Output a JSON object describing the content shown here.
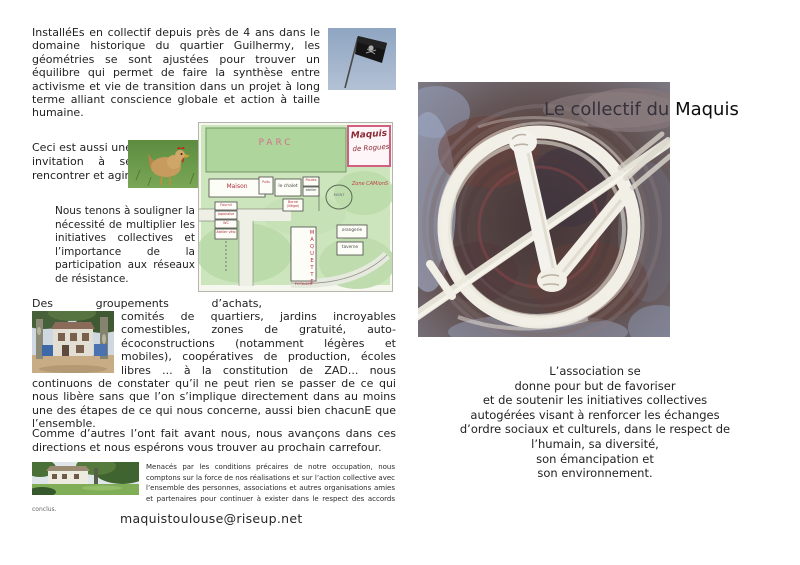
{
  "page_left": {
    "intro": "InstalléEs en collectif depuis près de 4 ans dans le domaine historique du quartier Guilhermy, les géométries se sont ajustées pour trouver un équilibre qui permet de faire la synthèse entre activisme et vie de transition dans un projet à long terme alliant conscience globale et action à taille humaine.",
    "invitation": "Ceci est aussi une invitation à se rencontrer et agir.",
    "souligner": "Nous tenons à souligner la nécessité de multiplier les initiatives collectives et l’importance de la participation aux réseaux de résistance.",
    "groupements_line1": "Des groupements d’achats,",
    "groupements_rest": "comités de quartiers, jardins incroyables comestibles, zones de gratuité, auto-écoconstructions (notamment légères et mobiles), coopératives de production, écoles libres ...  à la constitution de ZAD...  nous continuons de constater qu’il ne peut rien se passer de ce qui nous libère sans que l’on s’implique directement dans au moins une des étapes  de ce qui nous concerne, aussi bien chacunE que l’ensemble.",
    "carrefour": "Comme d’autres l’ont fait avant nous, nous avançons dans ces directions et nous espérons vous trouver au prochain carrefour.",
    "menaces": "Menacés par les conditions précaires de notre occupation, nous comptons sur la force de nos réalisations et sur l’action collective avec l’ensemble des personnes, associations et autres organisations amies et partenaires pour continuer à exister dans le respect des accords ",
    "menaces_suffix": "conclus.",
    "email": "maquistoulouse@riseup.net",
    "images": {
      "flag": "pirate-flag-photo",
      "hen": "hen-photo",
      "map": "hand-drawn-site-map",
      "house": "house-photo",
      "panorama": "house-panorama-photo"
    },
    "map": {
      "parc": "PARC",
      "title1": "Maquis",
      "title2": "de Rogues",
      "maison": "Maison",
      "puits": "Puits",
      "chalet": "le chalet",
      "poules": "Poules",
      "atelier": "atelier",
      "borne": "Borne (illégal)",
      "fournil": "Fournil",
      "japonaise": "Japonaise",
      "wc": "WC",
      "velo": "Atelier vélo",
      "mont": "MONT",
      "zone": "Zone CAMionS",
      "maquette": "MAQUETTE",
      "potager": "POTAGER",
      "orangerie": "orangerie",
      "taverne": "taverne"
    }
  },
  "page_right": {
    "title_prefix": "Le collectif du ",
    "title_emphasis": "Maquis",
    "association_lines": [
      "L’association se",
      "donne pour but de favoriser",
      "et de soutenir les initiatives collectives",
      "autogérées  visant à renforcer les échanges",
      "d’ordre sociaux et culturels, dans le respect de",
      "l’humain, sa diversité,",
      "son émancipation et",
      "son environnement."
    ]
  },
  "colors": {
    "map_accent_pink": "#d06080",
    "map_label_red": "#b03040",
    "painting_white": "#f2efe7",
    "painting_maroon": "#5c4240",
    "painting_slate": "#8b92a5"
  }
}
